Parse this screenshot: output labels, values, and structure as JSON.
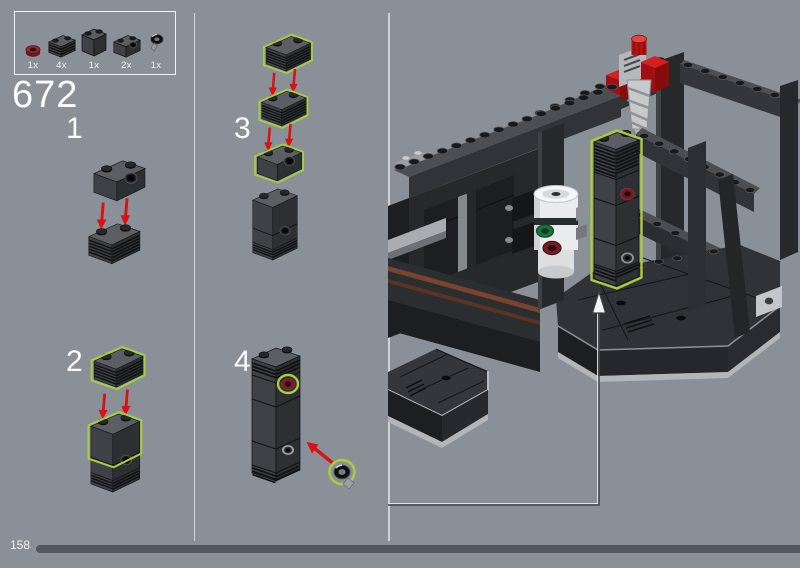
{
  "step": {
    "number": "672"
  },
  "substeps": [
    {
      "label": "1"
    },
    {
      "label": "2"
    },
    {
      "label": "3"
    },
    {
      "label": "4"
    }
  ],
  "parts_box": {
    "items": [
      {
        "count": "1x",
        "part": "dark-red-round-plate"
      },
      {
        "count": "4x",
        "part": "dark-gray-1x2-grille-brick"
      },
      {
        "count": "1x",
        "part": "dark-gray-1x2x2-brick"
      },
      {
        "count": "2x",
        "part": "dark-gray-1x2-technic-brick-with-hole"
      },
      {
        "count": "1x",
        "part": "black-round-plate-with-bar"
      }
    ]
  },
  "footer": {
    "page_number": "158"
  },
  "colors": {
    "background": "#8A9097",
    "highlight_green": "#A9CD3B",
    "arrow_red": "#D91111",
    "dark_red_part": "#6F1D23",
    "brick_gray": "#3E4246",
    "progress_bar": "#54585C",
    "divider": "#D6DADC",
    "text": "#FFFFFF"
  }
}
